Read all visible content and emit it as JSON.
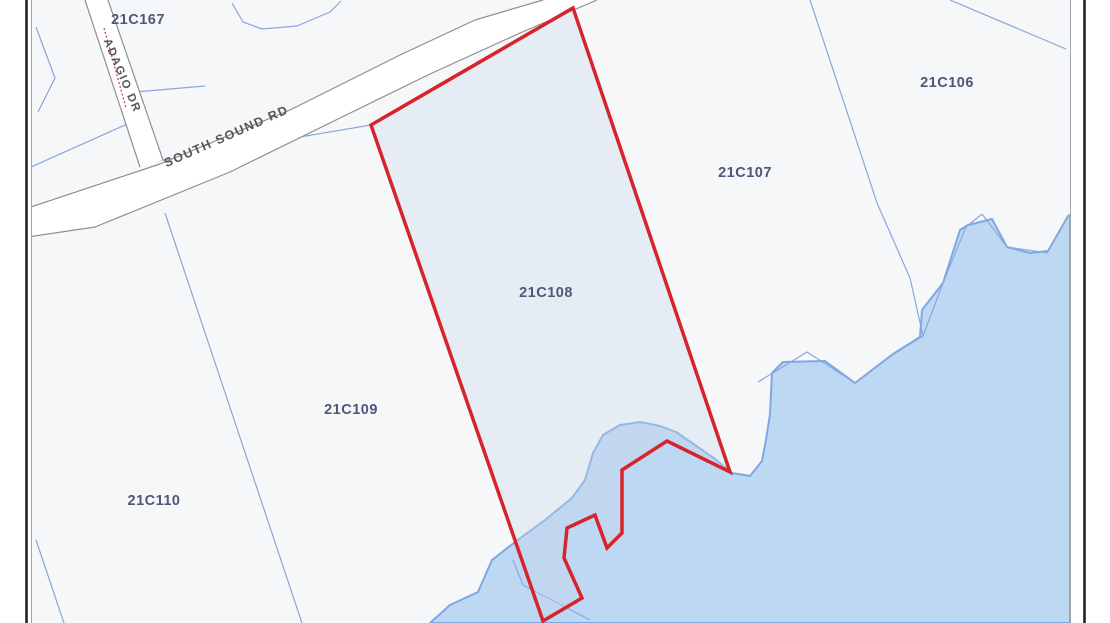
{
  "map": {
    "colors": {
      "page_bg": "#ffffff",
      "land": "#f6f7f8",
      "water_fill": "#bdd8f2",
      "water_stroke": "#7fa7e2",
      "parcel_line": "#8ba6de",
      "road_fill": "#ffffff",
      "road_edge": "#8f8f92",
      "highlight_stroke": "#d7232b",
      "highlight_fill": "rgba(198,216,236,0.35)",
      "parcel_label": "#4d5878",
      "road_label": "#55555a",
      "dotted_line": "#cc3a3a",
      "frame_black": "#1c1c1c",
      "frame_gray": "#a2a6ab"
    },
    "frame": {
      "left_black_x": 26.5,
      "left_gray_x": 31.5,
      "right_gray_x": 1070.5,
      "right_black_x": 1084.5
    },
    "content_clip": {
      "x": 32,
      "y": 0,
      "w": 1038,
      "h": 623
    },
    "water": {
      "points": "430,623 450,605 478,592 492,560 515,542 545,520 572,498 585,480 593,453 603,435 620,425 640,422 660,426 676,432 695,445 715,459 732,473 750,476 762,461 766,440 770,414 772,373 783,362 825,361 855,383 893,354 920,337 922,310 943,283 960,230 968,225 992,219 1007,247 1030,253 1048,251 1068,216 1070,215 1070,623"
    },
    "parcel_lines": [
      {
        "name": "boundary-sw-road-side",
        "points": "31,167 143,117"
      },
      {
        "name": "boundary-left-chevron",
        "points": "36,27 55,78 38,112"
      },
      {
        "name": "boundary-top-squiggle",
        "points": "232,3 243,22 262,29 297,26 330,12 341,1"
      },
      {
        "name": "boundary-adagio-east",
        "points": "135,92 205,86"
      },
      {
        "name": "boundary-ne-corner",
        "points": "950,0 1066,49"
      },
      {
        "name": "boundary-106-107-shore",
        "points": "810,0 853,130 877,203 910,278 923,336 892,355 855,383 807,352 758,382"
      },
      {
        "name": "boundary-junction-to-108",
        "points": "158,161 371,125"
      },
      {
        "name": "boundary-109-110",
        "points": "165,213 302,623"
      },
      {
        "name": "boundary-shore-east-outer",
        "points": "982,214 1007,247 1047,253 1068,216"
      },
      {
        "name": "boundary-shore-east-inner",
        "points": "982,214 966,227 943,283 923,336"
      },
      {
        "name": "boundary-sw-corner",
        "points": "36,540 64,623"
      },
      {
        "name": "boundary-water-inner-sw",
        "points": "513,560 523,585 590,620"
      }
    ],
    "roads": [
      {
        "id": "south-sound-rd",
        "label": "SOUTH SOUND RD",
        "label_x": 228,
        "label_y": 140,
        "label_rotate": -24,
        "label_size": 12.5,
        "polygon": "28,208 160,164 290,110 400,55 475,20 543,0 597,0 520,33 430,74 340,118 230,172 95,227 28,237",
        "edges": [
          "28,208 160,164 290,110 400,55 475,20 543,0",
          "597,0 520,33 430,74 340,118 230,172 95,227 28,237"
        ]
      },
      {
        "id": "adagio-dr",
        "label": "ADAGIO DR",
        "label_x": 119,
        "label_y": 77,
        "label_rotate": 67,
        "label_size": 11.5,
        "polygon": "85,0 108,0 163,160 140,167",
        "edges": [
          "85,0 140,167",
          "108,0 163,160"
        ]
      }
    ],
    "dotted_centerline": {
      "name": "adagio-dotted-line",
      "points": "104,28 126,108"
    },
    "highlight_parcel": {
      "id": "21C108",
      "points": "573,8 730,472 667,441 622,470 622,533 607,548 595,515 567,528 564,558 582,598 543,621 371,125"
    },
    "parcel_labels": [
      {
        "id": "21C167",
        "x": 138,
        "y": 19
      },
      {
        "id": "21C106",
        "x": 947,
        "y": 82
      },
      {
        "id": "21C107",
        "x": 745,
        "y": 172
      },
      {
        "id": "21C108",
        "x": 546,
        "y": 292
      },
      {
        "id": "21C109",
        "x": 351,
        "y": 409
      },
      {
        "id": "21C110",
        "x": 154,
        "y": 500
      }
    ]
  }
}
